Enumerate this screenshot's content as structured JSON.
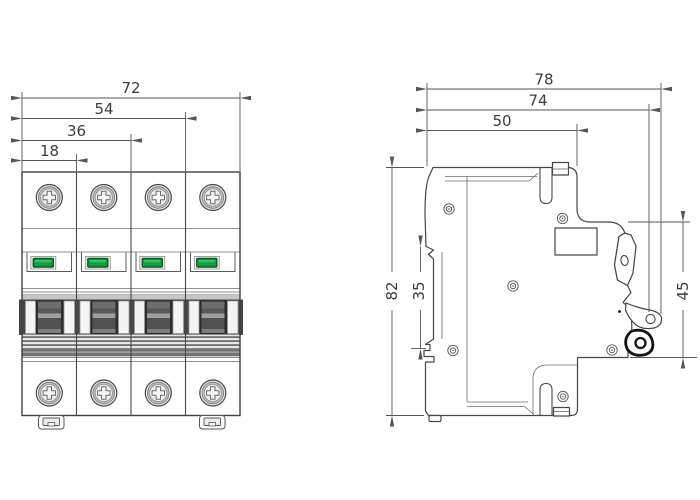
{
  "drawing": {
    "type": "circuit-breaker dimension drawing",
    "front": {
      "pole_count": 4,
      "dims": [
        {
          "label": "72"
        },
        {
          "label": "54"
        },
        {
          "label": "36"
        },
        {
          "label": "18"
        }
      ]
    },
    "side": {
      "horizontal": [
        {
          "label": "78"
        },
        {
          "label": "74"
        },
        {
          "label": "50"
        }
      ],
      "vertical": [
        {
          "label": "82"
        },
        {
          "label": "35"
        },
        {
          "label": "45"
        }
      ]
    },
    "colors": {
      "indicator_green": "#129e3e",
      "indicator_green_border": "#0a5a22",
      "line": "#45474b"
    }
  }
}
